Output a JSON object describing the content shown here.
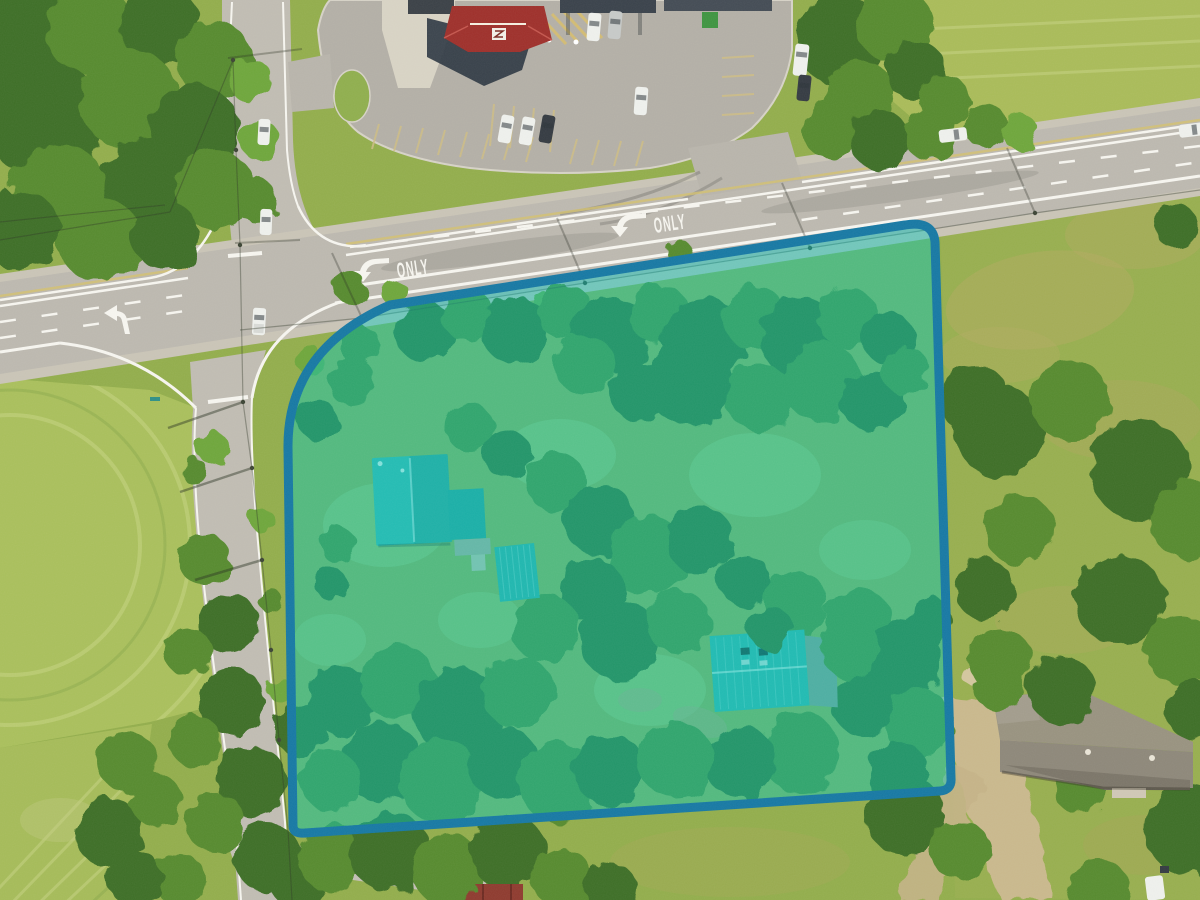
{
  "scene": {
    "road_markings": {
      "only_east": "ONLY",
      "only_west": "ONLY"
    },
    "colors": {
      "grass_base": "#92ad4b",
      "field_light": "#a9bf5b",
      "topright_field": "#a9bb58",
      "lawn_right": "#97ae4e",
      "road_shoulder": "#c9c4b6",
      "road_asphalt": "#bcb8af",
      "side_road_asphalt": "#c0bcb2",
      "bottom_street": "#c3bfb4",
      "parking_asphalt": "#b3afa6",
      "line_white": "#f6f5ef",
      "line_yellow": "#d3c06e",
      "overlay_fill": "#00c9c0",
      "overlay_fill_opacity": "0.44",
      "overlay_stroke": "#1678a3",
      "overlay_stroke_width": "9",
      "roof_red": "#9e2f2a",
      "building_shadow": "#2e3742",
      "roof_teal_house": "#3fb3a9",
      "roof_teal_shed": "#38aaa2",
      "roof_teal_barn": "#39b0a8",
      "roof_gray_ranch": "#8d8779",
      "roof_red_small": "#8e3a2e",
      "dirt_trail": "#c9b88c"
    }
  }
}
